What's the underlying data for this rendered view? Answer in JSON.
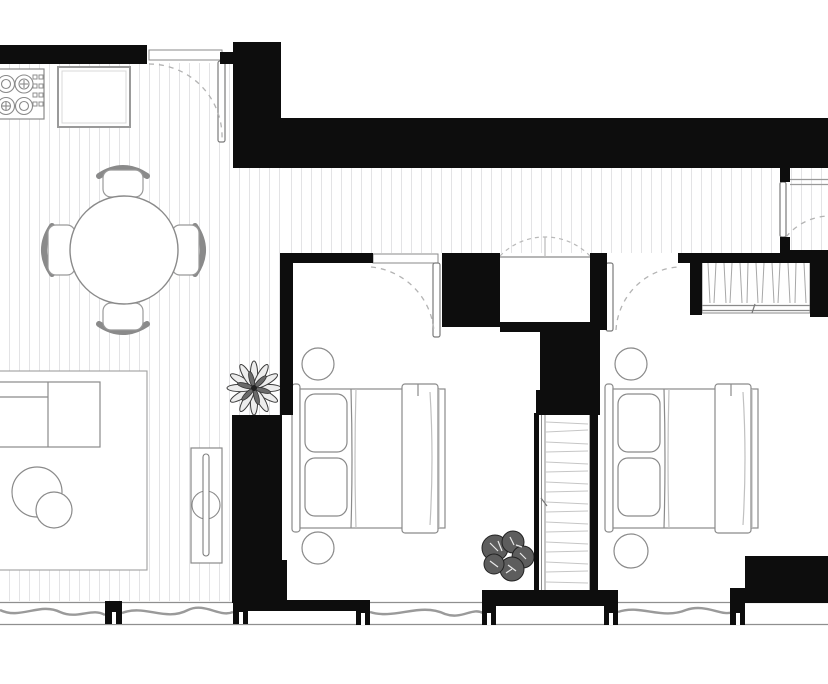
{
  "title": "apartment-floor-plan",
  "colors": {
    "wall": "#0d0d0d",
    "furniture_line": "#8a8a8a",
    "floor_stripe": "#e3e3e5",
    "door_swing_dash": "#b3b3b3",
    "plant_dark": "#555555",
    "background": "#ffffff"
  },
  "rooms": [
    {
      "name": "living-room-with-kitchen",
      "floor": "striped-wood"
    },
    {
      "name": "hallway",
      "floor": "striped-wood"
    },
    {
      "name": "bedroom-1",
      "floor": "plain"
    },
    {
      "name": "bedroom-2",
      "floor": "plain"
    },
    {
      "name": "hallway-closet",
      "floor": "plain"
    },
    {
      "name": "side-room-right",
      "floor": "striped-wood"
    }
  ],
  "furniture": [
    {
      "name": "stove-4-burner-hob",
      "room": "living-room-with-kitchen"
    },
    {
      "name": "kitchen-cabinet-square",
      "room": "living-room-with-kitchen"
    },
    {
      "name": "round-dining-table",
      "room": "living-room-with-kitchen",
      "chairs": 4
    },
    {
      "name": "sofa-sectional",
      "room": "living-room-with-kitchen"
    },
    {
      "name": "area-rug",
      "room": "living-room-with-kitchen"
    },
    {
      "name": "round-coffee-tables",
      "room": "living-room-with-kitchen",
      "count": 2
    },
    {
      "name": "tv-sideboard",
      "room": "living-room-with-kitchen"
    },
    {
      "name": "potted-plant-star",
      "room": "living-room-with-kitchen"
    },
    {
      "name": "double-bed",
      "room": "bedroom-1",
      "pillows": 2
    },
    {
      "name": "round-nightstands",
      "room": "bedroom-1",
      "count": 2
    },
    {
      "name": "potted-plant-leafy",
      "room": "bedroom-1"
    },
    {
      "name": "built-in-wardrobe-shaft",
      "room": "bedroom-1"
    },
    {
      "name": "double-bed",
      "room": "bedroom-2",
      "pillows": 2
    },
    {
      "name": "round-nightstands",
      "room": "bedroom-2",
      "count": 2
    },
    {
      "name": "wardrobe-with-hanging-rail",
      "room": "bedroom-2"
    },
    {
      "name": "wall-shelf",
      "room": "side-room-right"
    }
  ],
  "doors": [
    {
      "name": "entrance-door",
      "type": "swing",
      "style": "dashed-arc"
    },
    {
      "name": "bedroom-1-door",
      "type": "swing",
      "style": "dashed-arc"
    },
    {
      "name": "bedroom-2-door",
      "type": "swing",
      "style": "dashed-arc"
    },
    {
      "name": "side-room-door",
      "type": "swing",
      "style": "dashed-arc"
    },
    {
      "name": "hallway-closet-doors",
      "type": "double-swing",
      "style": "dashed-arc"
    }
  ],
  "windows": [
    {
      "name": "window-living-left"
    },
    {
      "name": "window-living-right"
    },
    {
      "name": "window-bedroom-1"
    },
    {
      "name": "window-bedroom-2"
    }
  ]
}
